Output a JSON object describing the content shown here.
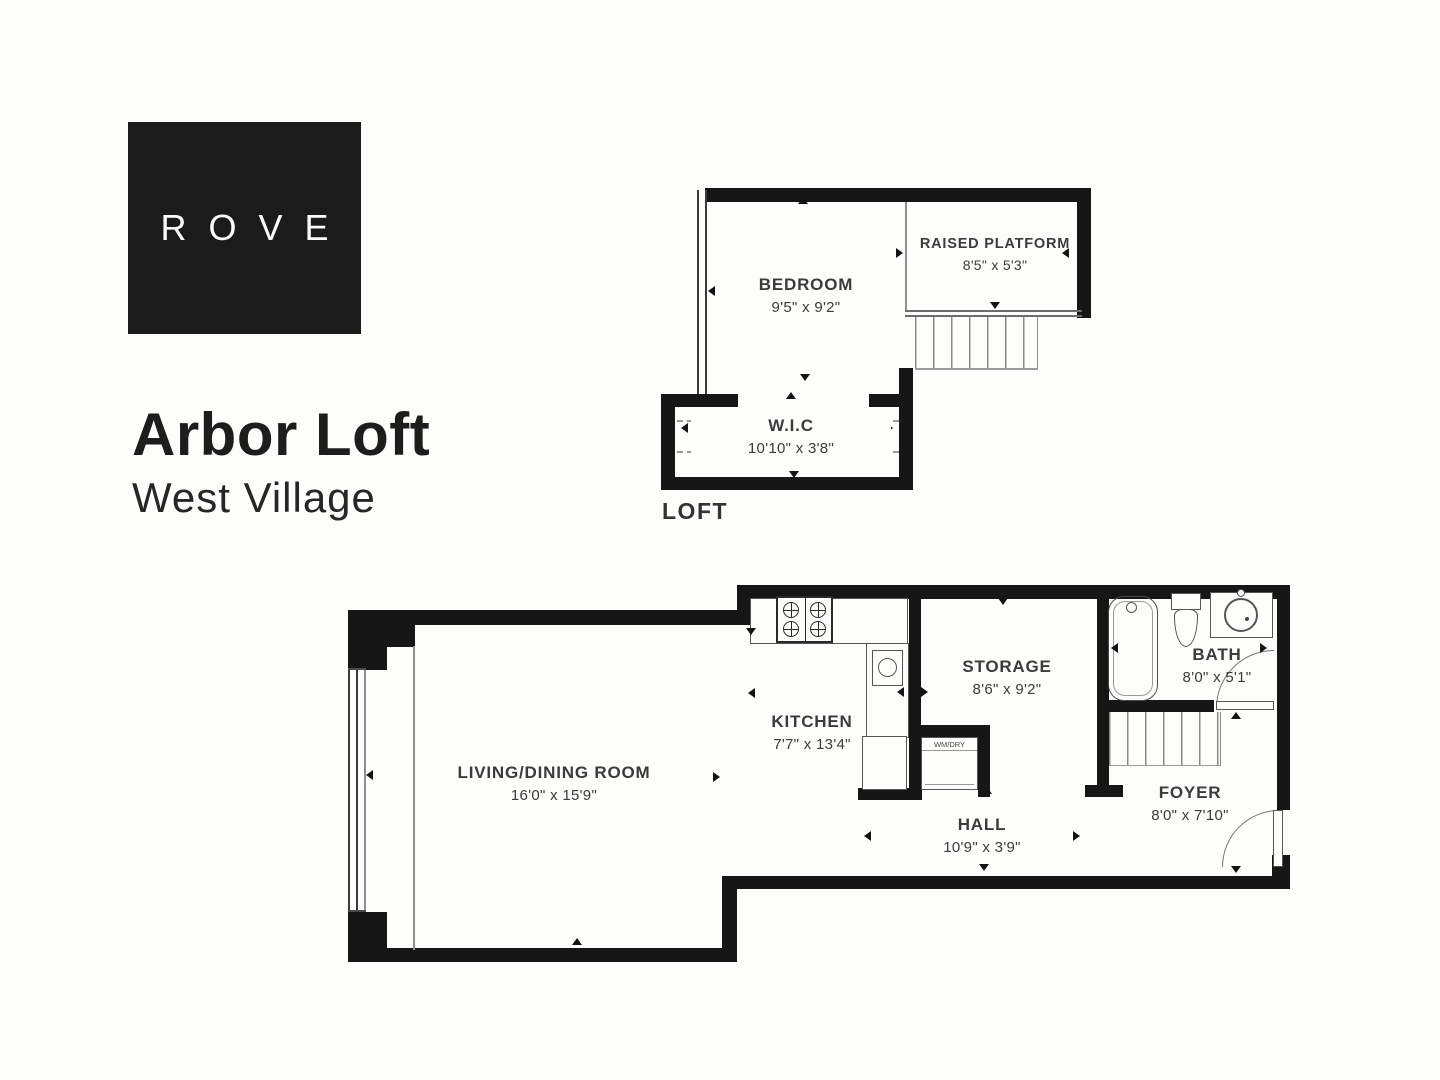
{
  "brand": {
    "logo": "ROVE",
    "title": "Arbor Loft",
    "subtitle": "West Village"
  },
  "loft": {
    "plan_label": "LOFT",
    "rooms": [
      {
        "name": "BEDROOM",
        "dims": "9'5\" x 9'2\""
      },
      {
        "name": "RAISED PLATFORM",
        "dims": "8'5\" x 5'3\""
      },
      {
        "name": "W.I.C",
        "dims": "10'10\" x 3'8\""
      }
    ]
  },
  "main": {
    "rooms": [
      {
        "name": "LIVING/DINING ROOM",
        "dims": "16'0\" x 15'9\""
      },
      {
        "name": "KITCHEN",
        "dims": "7'7\" x 13'4\""
      },
      {
        "name": "STORAGE",
        "dims": "8'6\" x 9'2\""
      },
      {
        "name": "BATH",
        "dims": "8'0\" x 5'1\""
      },
      {
        "name": "HALL",
        "dims": "10'9\" x 3'9\""
      },
      {
        "name": "FOYER",
        "dims": "8'0\" x 7'10\""
      }
    ],
    "washer_label": "WM/DRY"
  },
  "colors": {
    "wall": "#161616",
    "logo_bg": "#1b1b1b",
    "label_text": "#3b3b3b",
    "background": "#fdfdfc"
  }
}
